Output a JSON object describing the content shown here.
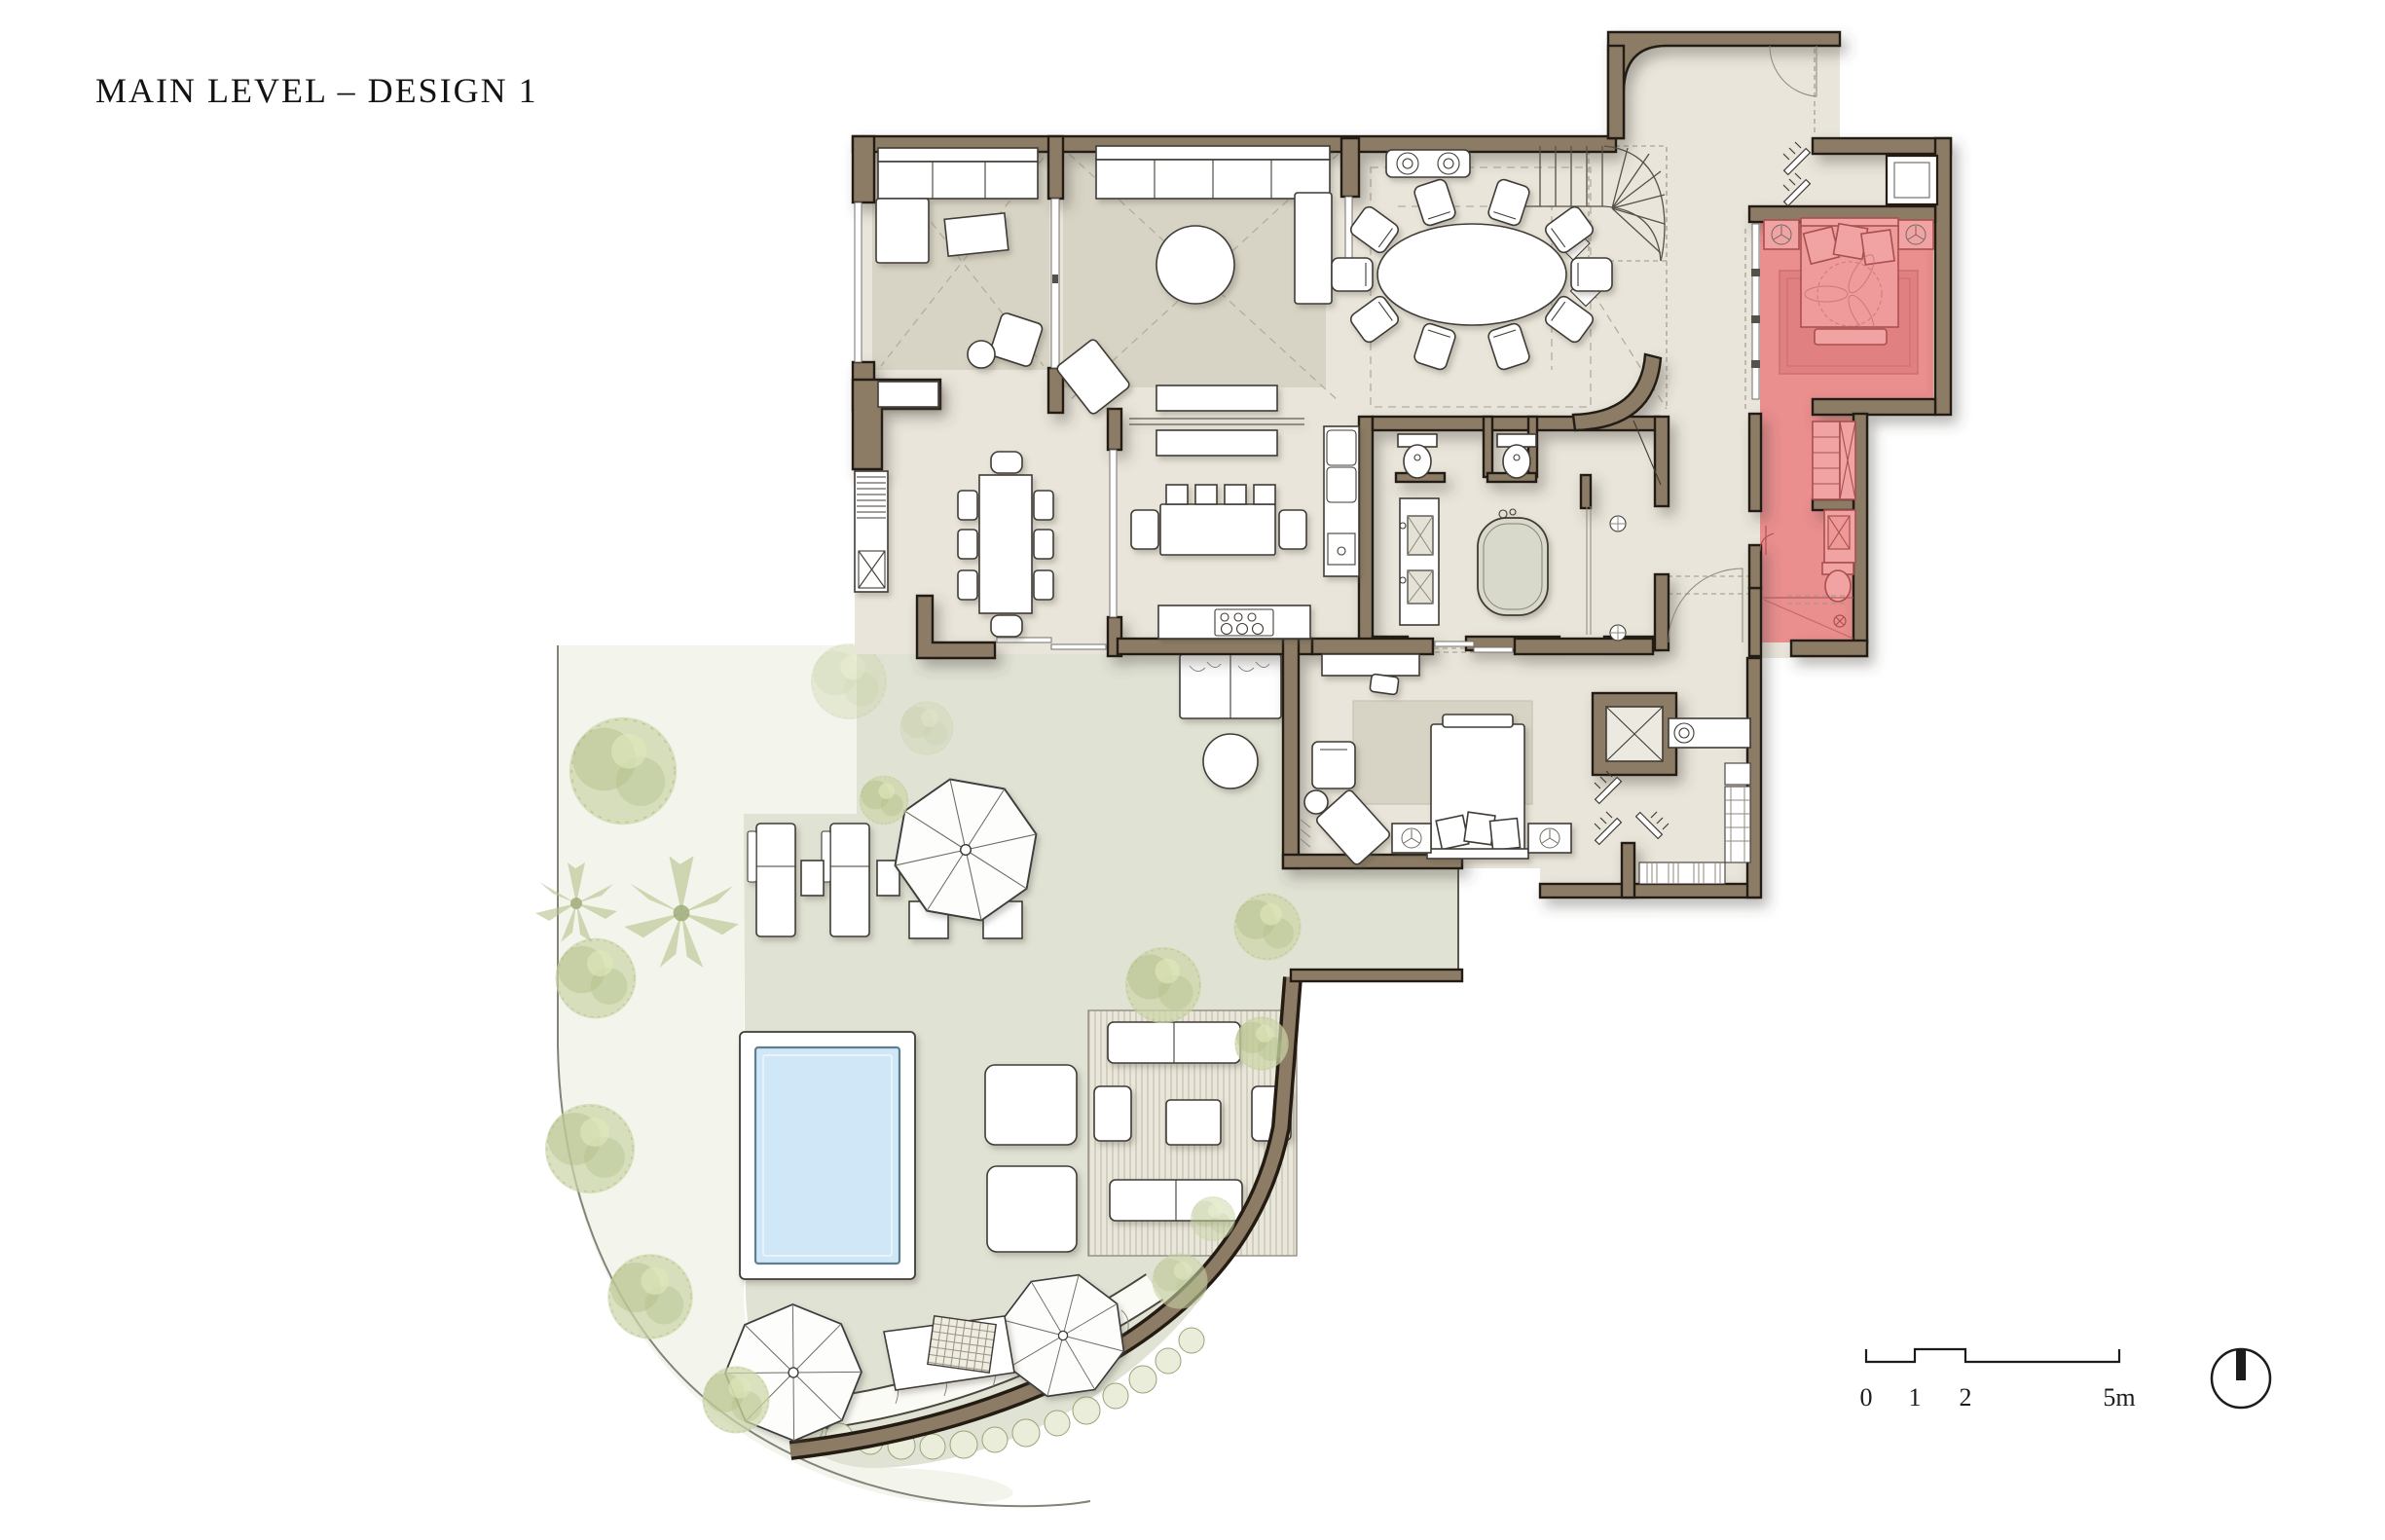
{
  "title": "MAIN LEVEL – DESIGN 1",
  "scale_bar": {
    "labels": [
      "0",
      "1",
      "2",
      "5m"
    ]
  },
  "colors": {
    "wall": "#8d7c65",
    "outline": "#241c12",
    "floor": "#e9e5da",
    "rug": "#d8d4c5",
    "deck": "#e0e2d4",
    "garden": "#f3f5ec",
    "tree": "#ccd5a7",
    "tree_dark": "#aebb84",
    "red": "#ea8e8e",
    "red_dark": "#a8504f",
    "red_light": "#f1a3a3",
    "red_rug": "#e08080",
    "pool": "#cfe7f6",
    "pool_edge": "#5e7f91",
    "line": "#3f3b35",
    "dash": "#b3ad9e"
  }
}
